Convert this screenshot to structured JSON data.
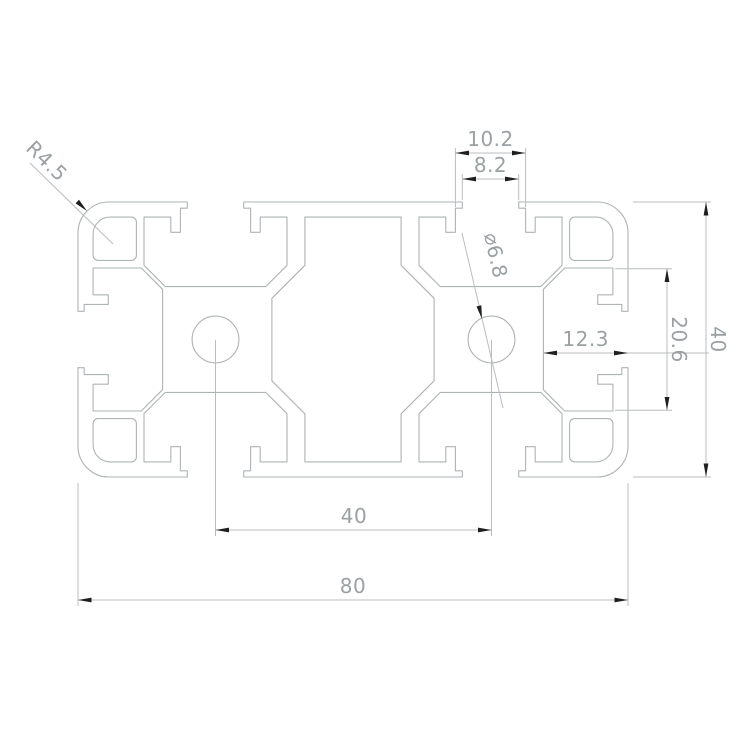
{
  "drawing": {
    "type": "technical-cad-cross-section",
    "subject": "8040 aluminum extrusion profile",
    "background_color": "#ffffff",
    "profile_line_color": "#aeb3b5",
    "dimension_line_color": "#b9bdbf",
    "dimension_text_color": "#9ba0a3",
    "arrowhead_color": "#1f1f1f",
    "dimensions": {
      "slot_step_width": "10.2",
      "slot_opening_width": "8.2",
      "corner_radius": "R4.5",
      "hole_diameter": "⌀6.8",
      "slot_depth": "12.3",
      "side_cavity_height": "20.6",
      "profile_height": "40",
      "hole_spacing": "40",
      "profile_width": "80"
    }
  }
}
